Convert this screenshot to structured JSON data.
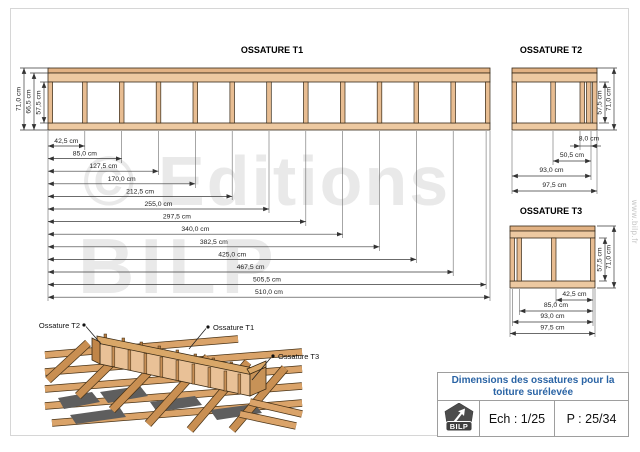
{
  "page": {
    "watermark_line1": "© Editions",
    "watermark_line2": "BILP",
    "side_text": "www.bilp.fr"
  },
  "t1": {
    "title": "OSSATURE T1",
    "height_dims": [
      "71,0 cm",
      "66,5 cm",
      "57,5 cm"
    ],
    "width_dims": [
      "42,5 cm",
      "85,0 cm",
      "127,5 cm",
      "170,0 cm",
      "212,5 cm",
      "255,0 cm",
      "297,5 cm",
      "340,0 cm",
      "382,5 cm",
      "425,0 cm",
      "467,5 cm",
      "505,5 cm",
      "510,0 cm"
    ]
  },
  "t2": {
    "title": "OSSATURE T2",
    "height_dims": [
      "57,5 cm",
      "71,0 cm"
    ],
    "width_dims": [
      "8,0 cm",
      "50,5 cm",
      "93,0 cm",
      "97,5 cm"
    ]
  },
  "t3": {
    "title": "OSSATURE T3",
    "height_dims": [
      "57,5 cm",
      "71,0 cm"
    ],
    "width_dims": [
      "42,5 cm",
      "85,0 cm",
      "93,0 cm",
      "97,5 cm"
    ]
  },
  "iso": {
    "labels": [
      "Ossature T2",
      "Ossature T1",
      "Ossature T3"
    ]
  },
  "title_block": {
    "title_line1": "Dimensions des ossatures pour la",
    "title_line2": "toiture surélevée",
    "logo_text": "BILP",
    "scale_label": "Ech : 1/25",
    "page_label": "P : 25/34"
  },
  "colors": {
    "wood_fill": "#edc9a1",
    "wood_dark": "#c98f52",
    "title_blue": "#2a64a5",
    "watermark_gray": "#e9e9e9"
  }
}
